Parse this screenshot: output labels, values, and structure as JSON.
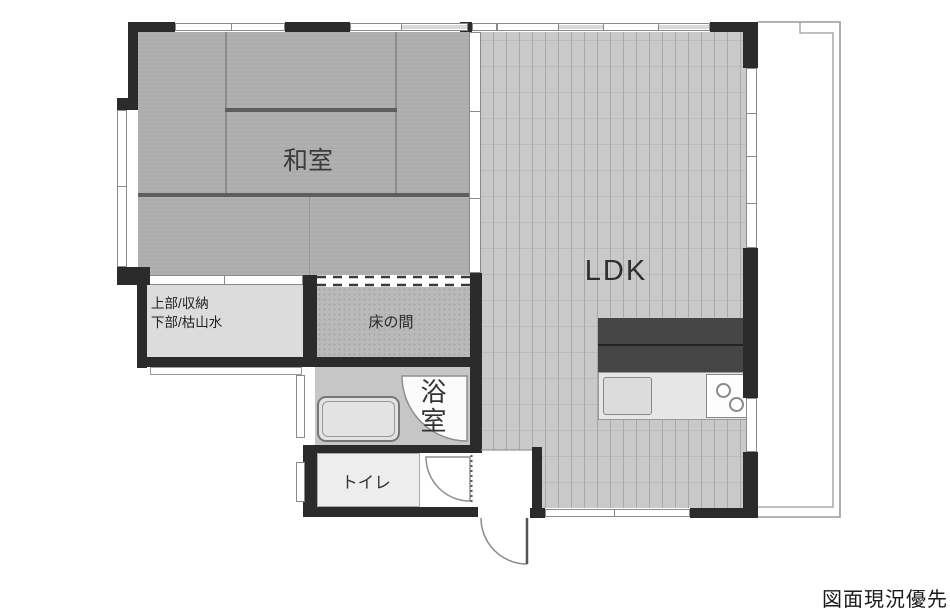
{
  "plan": {
    "rooms": {
      "washitsu": {
        "label": "和室"
      },
      "ldk": {
        "label": "LDK"
      },
      "tokonoma": {
        "label": "床の間"
      },
      "closet": {
        "line1": "上部/収納",
        "line2": "下部/枯山水"
      },
      "bathroom": {
        "label": "浴室"
      },
      "toilet": {
        "label": "トイレ"
      }
    },
    "note": "図面現況優先",
    "colors": {
      "wall": "#2b2b2b",
      "tatami": "#acacac",
      "ldk_floor": "#c9c9c9",
      "tokonoma_floor": "#b9b9b9",
      "closet_floor": "#dcdcdc",
      "bathroom_floor": "#c6c6c6",
      "toilet_floor": "#ededed",
      "kitchen_counter": "#454545",
      "fixture_light": "#e6e6e6",
      "balcony_line": "#999999"
    },
    "icons": [
      "door-swing-arc-entrance",
      "door-swing-arc-bathroom",
      "door-swing-arc-toilet",
      "bathtub",
      "kitchen-sink",
      "stove-burners",
      "window-strips",
      "balcony-outline"
    ]
  }
}
